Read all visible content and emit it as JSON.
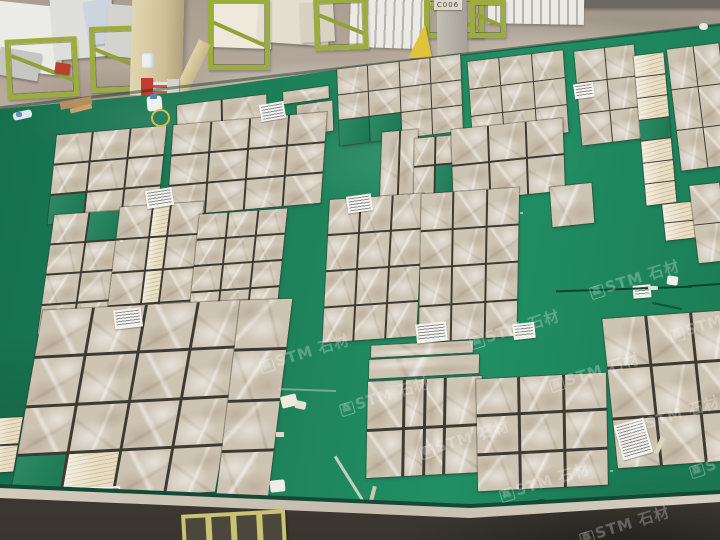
{
  "meta": {
    "description": "Photograph: dry-lay inspection area in a stone factory. Beige emperador-light marble tiles are laid out in grid patterns on a green painted floor; slabs and green racks line the warehouse wall at the top; small white specification cards (text illegible) sit beside tile groups.",
    "scene_type": "photograph"
  },
  "sign": {
    "text": "C006"
  },
  "watermark": {
    "text": "STM 石材",
    "logo_text": "鑫",
    "color": "#ffffff",
    "opacity": 0.27,
    "instances": [
      {
        "x": 258,
        "y": 342
      },
      {
        "x": 338,
        "y": 385
      },
      {
        "x": 418,
        "y": 428
      },
      {
        "x": 498,
        "y": 471
      },
      {
        "x": 578,
        "y": 514
      },
      {
        "x": 468,
        "y": 318
      },
      {
        "x": 548,
        "y": 361
      },
      {
        "x": 628,
        "y": 404
      },
      {
        "x": 688,
        "y": 447
      },
      {
        "x": 588,
        "y": 268
      },
      {
        "x": 668,
        "y": 311
      }
    ]
  },
  "palette": {
    "floor_green": "#1d8158",
    "grout_dark": "#3d3a31",
    "marble_base": "#cec4b4",
    "travertine_strip": "#e8dec5",
    "concrete_top": "#b2a79a",
    "rack_green": "#9dac3e",
    "stand_yellow": "#e0c33c",
    "curb_light": "#cdc5b6",
    "concrete_dark": "#46423b"
  },
  "tile_groups": [
    {
      "x": 177,
      "y": 100,
      "w": 90,
      "h": 40,
      "cols": 2,
      "rows": 1,
      "rot": -7,
      "skew": -6,
      "gap": 2
    },
    {
      "x": 283,
      "y": 89,
      "w": 46,
      "h": 12,
      "cols": 1,
      "rows": 1,
      "rot": -8,
      "skew": -6,
      "gap": 1
    },
    {
      "x": 297,
      "y": 103,
      "w": 36,
      "h": 30,
      "cols": 1,
      "rows": 1,
      "rot": -8,
      "skew": -6,
      "gap": 1
    },
    {
      "x": 338,
      "y": 62,
      "w": 124,
      "h": 76,
      "cols": 4,
      "rows": 3,
      "rot": -7,
      "skew": -5,
      "gap": 1,
      "holes": [
        8,
        9
      ]
    },
    {
      "x": 470,
      "y": 56,
      "w": 96,
      "h": 82,
      "cols": 3,
      "rows": 3,
      "rot": -7,
      "skew": -3,
      "gap": 1
    },
    {
      "x": 578,
      "y": 48,
      "w": 60,
      "h": 94,
      "cols": 2,
      "rows": 3,
      "rot": -7,
      "skew": -2,
      "gap": 1
    },
    {
      "x": 640,
      "y": 54,
      "w": 30,
      "h": 150,
      "cols": 1,
      "rows": 7,
      "rot": -7,
      "skew": -2,
      "gap": 1,
      "allStrip": true,
      "holes": [
        3
      ]
    },
    {
      "x": 674,
      "y": 46,
      "w": 52,
      "h": 122,
      "cols": 2,
      "rows": 3,
      "rot": -7,
      "skew": 0,
      "gap": 1
    },
    {
      "x": 664,
      "y": 203,
      "w": 32,
      "h": 36,
      "cols": 1,
      "rows": 2,
      "rot": -6,
      "skew": 0,
      "gap": 1,
      "allStrip": true
    },
    {
      "x": 694,
      "y": 184,
      "w": 30,
      "h": 78,
      "cols": 1,
      "rows": 2,
      "rot": -6,
      "skew": 1,
      "gap": 1
    },
    {
      "x": 52,
      "y": 131,
      "w": 110,
      "h": 88,
      "cols": 3,
      "rows": 3,
      "rot": -5,
      "skew": -11,
      "gap": 2,
      "holes": [
        6
      ]
    },
    {
      "x": 170,
      "y": 119,
      "w": 154,
      "h": 90,
      "cols": 4,
      "rows": 3,
      "rot": -5,
      "skew": -9,
      "gap": 2
    },
    {
      "x": 46,
      "y": 212,
      "w": 106,
      "h": 118,
      "cols": 3,
      "rows": 4,
      "rot": -4,
      "skew": -12,
      "gap": 2,
      "holes": [
        1
      ]
    },
    {
      "x": 112,
      "y": 205,
      "w": 84,
      "h": 130,
      "cols": 3,
      "rows": 4,
      "rot": -4,
      "skew": -11,
      "gap": 2,
      "colTemplate": "1.1fr .55fr 1.1fr",
      "strips": [
        1,
        4,
        7
      ]
    },
    {
      "x": 194,
      "y": 212,
      "w": 88,
      "h": 102,
      "cols": 3,
      "rows": 4,
      "rot": -4,
      "skew": -10,
      "gap": 2
    },
    {
      "x": 381,
      "y": 131,
      "w": 36,
      "h": 64,
      "cols": 2,
      "rows": 1,
      "rot": -5,
      "skew": -7,
      "gap": 2
    },
    {
      "x": 414,
      "y": 137,
      "w": 42,
      "h": 56,
      "cols": 2,
      "rows": 2,
      "rot": -5,
      "skew": -6,
      "gap": 2,
      "holes": [
        3
      ]
    },
    {
      "x": 452,
      "y": 124,
      "w": 112,
      "h": 72,
      "cols": 3,
      "rows": 2,
      "rot": -6,
      "skew": -4,
      "gap": 2
    },
    {
      "x": 326,
      "y": 197,
      "w": 94,
      "h": 142,
      "cols": 3,
      "rows": 4,
      "rot": -4,
      "skew": -7,
      "gap": 2
    },
    {
      "x": 420,
      "y": 191,
      "w": 98,
      "h": 148,
      "cols": 3,
      "rows": 4,
      "rot": -4,
      "skew": -5,
      "gap": 2
    },
    {
      "x": 551,
      "y": 185,
      "w": 42,
      "h": 40,
      "cols": 1,
      "rows": 1,
      "rot": -6,
      "skew": -2,
      "gap": 2
    },
    {
      "x": 26,
      "y": 306,
      "w": 206,
      "h": 190,
      "cols": 4,
      "rows": 4,
      "rot": -3,
      "skew": -13,
      "gap": 3,
      "holes": [
        12
      ],
      "strips": [
        13
      ]
    },
    {
      "x": 228,
      "y": 300,
      "w": 52,
      "h": 200,
      "cols": 1,
      "rows": 4,
      "rot": -2,
      "skew": -9,
      "gap": 3
    },
    {
      "x": 371,
      "y": 343,
      "w": 102,
      "h": 12,
      "cols": 1,
      "rows": 1,
      "rot": -3,
      "skew": -4,
      "gap": 2
    },
    {
      "x": 369,
      "y": 357,
      "w": 110,
      "h": 19,
      "cols": 1,
      "rows": 1,
      "rot": -3,
      "skew": -4,
      "gap": 2
    },
    {
      "x": 367,
      "y": 379,
      "w": 114,
      "h": 96,
      "cols": 4,
      "rows": 2,
      "rot": -3,
      "skew": -4,
      "gap": 3,
      "colTemplate": "1fr .52fr .52fr 1fr"
    },
    {
      "x": 477,
      "y": 376,
      "w": 130,
      "h": 112,
      "cols": 3,
      "rows": 3,
      "rot": -3,
      "skew": -2,
      "gap": 3
    },
    {
      "x": 610,
      "y": 314,
      "w": 132,
      "h": 150,
      "cols": 3,
      "rows": 3,
      "rot": -4,
      "skew": 2,
      "gap": 3
    },
    {
      "x": -8,
      "y": 418,
      "w": 26,
      "h": 54,
      "cols": 1,
      "rows": 2,
      "rot": -3,
      "skew": -13,
      "gap": 2,
      "allStrip": true
    }
  ],
  "labels": [
    {
      "x": 260,
      "y": 103,
      "w": 21,
      "h": 13,
      "rot": -10
    },
    {
      "x": 574,
      "y": 83,
      "w": 16,
      "h": 11,
      "rot": -8
    },
    {
      "x": 146,
      "y": 189,
      "w": 23,
      "h": 14,
      "rot": -9
    },
    {
      "x": 347,
      "y": 195,
      "w": 21,
      "h": 13,
      "rot": -8
    },
    {
      "x": 114,
      "y": 309,
      "w": 24,
      "h": 15,
      "rot": -7
    },
    {
      "x": 416,
      "y": 323,
      "w": 27,
      "h": 15,
      "rot": -6
    },
    {
      "x": 513,
      "y": 323,
      "w": 18,
      "h": 12,
      "rot": -6
    },
    {
      "x": 633,
      "y": 285,
      "w": 14,
      "h": 9,
      "rot": -5
    },
    {
      "x": 618,
      "y": 421,
      "w": 27,
      "h": 32,
      "rot": -16
    },
    {
      "x": 77,
      "y": 487,
      "w": 40,
      "h": 24,
      "rot": -3
    }
  ],
  "debris": [
    {
      "name": "white-jug",
      "x": 147,
      "y": 96,
      "w": 15,
      "h": 15,
      "bg": "#eef1f2",
      "radius": "3px",
      "rot": -5
    },
    {
      "name": "jug-cap",
      "x": 150,
      "y": 94,
      "w": 7,
      "h": 5,
      "bg": "#5a82b8",
      "radius": "1px"
    },
    {
      "name": "wire-coil",
      "x": 151,
      "y": 109,
      "w": 15,
      "h": 14,
      "border": "2px solid #d4bd55",
      "radius": "50%"
    },
    {
      "name": "wood-plank",
      "x": 60,
      "y": 99,
      "w": 32,
      "h": 8,
      "bg": "#b78c5e",
      "rot": -10
    },
    {
      "name": "wood-plank",
      "x": 70,
      "y": 106,
      "w": 22,
      "h": 5,
      "bg": "#caa06c",
      "rot": -14
    },
    {
      "name": "plastic-bottle",
      "x": 13,
      "y": 111,
      "w": 19,
      "h": 8,
      "bg": "#e3e8ec",
      "radius": "3px",
      "rot": -12
    },
    {
      "name": "bottle-cap",
      "x": 16,
      "y": 112,
      "w": 6,
      "h": 5,
      "bg": "#6b8fc0",
      "radius": "2px"
    },
    {
      "name": "foam-piece",
      "x": 281,
      "y": 395,
      "w": 16,
      "h": 12,
      "bg": "#efeade",
      "radius": "2px",
      "rot": -14
    },
    {
      "name": "foam-piece",
      "x": 295,
      "y": 401,
      "w": 11,
      "h": 8,
      "bg": "#e6e0d4",
      "radius": "2px",
      "rot": 12
    },
    {
      "name": "foam-piece",
      "x": 276,
      "y": 432,
      "w": 8,
      "h": 5,
      "bg": "#ddd8cb"
    },
    {
      "name": "foam-box",
      "x": 270,
      "y": 480,
      "w": 15,
      "h": 12,
      "bg": "#f2ede4",
      "radius": "2px",
      "rot": -6
    },
    {
      "name": "foam-piece",
      "x": 667,
      "y": 276,
      "w": 11,
      "h": 9,
      "bg": "#eef0ea",
      "radius": "2px",
      "rot": 8
    },
    {
      "name": "white-object",
      "x": 699,
      "y": 23,
      "w": 9,
      "h": 7,
      "bg": "#e9e9e5",
      "radius": "50%"
    },
    {
      "name": "stone-stick",
      "x": 657,
      "y": 437,
      "w": 5,
      "h": 17,
      "bg": "#ddd5c0",
      "radius": "1px",
      "rot": 24
    },
    {
      "name": "stone-stick",
      "x": 371,
      "y": 486,
      "w": 4,
      "h": 15,
      "bg": "#cfc7b4",
      "rot": 14
    },
    {
      "name": "metal-clamp",
      "x": 532,
      "y": 499,
      "w": 22,
      "h": 27,
      "bg": "#3b372e",
      "radius": "30% 50% 20% 40%",
      "rot": -12
    },
    {
      "name": "metal-clamp",
      "x": 564,
      "y": 501,
      "w": 19,
      "h": 27,
      "bg": "#464238",
      "radius": "40% 30% 40% 20%",
      "rot": 10
    },
    {
      "name": "floor-crack",
      "x": 556,
      "y": 288,
      "w": 136,
      "h": 2,
      "bg": "#0d4430",
      "rot": -2
    },
    {
      "name": "floor-crack",
      "x": 688,
      "y": 284,
      "w": 34,
      "h": 2,
      "bg": "#0d4430",
      "rot": -4
    },
    {
      "name": "crack-filler",
      "x": 648,
      "y": 286,
      "w": 10,
      "h": 4,
      "bg": "#dfe4da",
      "radius": "2px"
    },
    {
      "name": "floor-scratch",
      "x": 349,
      "y": 452,
      "w": 3,
      "h": 58,
      "bg": "rgba(225,220,205,.85)",
      "rot": -32
    },
    {
      "name": "floor-scratch",
      "x": 278,
      "y": 389,
      "w": 58,
      "h": 2,
      "bg": "rgba(210,205,190,.5)",
      "rot": 2
    },
    {
      "name": "hook-mark",
      "x": 652,
      "y": 305,
      "w": 30,
      "h": 2,
      "bg": "#14523a",
      "rot": 12
    },
    {
      "name": "paint-fleck",
      "x": 120,
      "y": 240,
      "w": 3,
      "h": 2,
      "bg": "rgba(235,235,225,.6)"
    },
    {
      "name": "paint-fleck",
      "x": 520,
      "y": 212,
      "w": 3,
      "h": 2,
      "bg": "rgba(235,235,225,.6)"
    },
    {
      "name": "paint-fleck",
      "x": 200,
      "y": 430,
      "w": 4,
      "h": 2,
      "bg": "rgba(235,235,225,.5)"
    },
    {
      "name": "paint-fleck",
      "x": 610,
      "y": 470,
      "w": 3,
      "h": 2,
      "bg": "rgba(235,235,225,.5)"
    }
  ],
  "warehouse": {
    "slabs": [
      {
        "x": -8,
        "y": 4,
        "w": 72,
        "h": 68,
        "rot": 6,
        "bg": "#ebebe8"
      },
      {
        "x": 52,
        "y": -4,
        "w": 62,
        "h": 62,
        "rot": -5,
        "bg": "#dfdfdb"
      },
      {
        "x": 86,
        "y": 0,
        "w": 28,
        "h": 44,
        "rot": -9,
        "bg": "#ccd5dd"
      },
      {
        "x": 106,
        "y": 6,
        "w": 54,
        "h": 52,
        "rot": 5,
        "bg": "#d3d3cf"
      },
      {
        "x": -2,
        "y": 50,
        "w": 42,
        "h": 28,
        "rot": 10,
        "bg": "#c6c7c3"
      },
      {
        "x": 210,
        "y": -6,
        "w": 62,
        "h": 54,
        "rot": 2,
        "bg": "#efe9dc"
      },
      {
        "x": 258,
        "y": -4,
        "w": 72,
        "h": 48,
        "rot": 4,
        "bg": "#e4decf"
      },
      {
        "x": 300,
        "y": 2,
        "w": 34,
        "h": 40,
        "rot": -3,
        "bg": "#d8d2c2"
      },
      {
        "x": 580,
        "y": -2,
        "w": 146,
        "h": 10,
        "rot": 0,
        "bg": "#6e6862"
      }
    ],
    "stacks": [
      {
        "x": 350,
        "y": -2,
        "w": 80,
        "h": 50,
        "rot": 2
      },
      {
        "x": 488,
        "y": -2,
        "w": 96,
        "h": 26,
        "rot": 1
      }
    ],
    "frames": [
      {
        "x": 6,
        "y": 38,
        "w": 62,
        "h": 50,
        "rot": -3
      },
      {
        "x": 90,
        "y": 26,
        "w": 48,
        "h": 56,
        "rot": -2
      },
      {
        "x": 208,
        "y": -2,
        "w": 52,
        "h": 62,
        "rot": 0
      },
      {
        "x": 314,
        "y": -2,
        "w": 44,
        "h": 42,
        "rot": -2
      },
      {
        "x": 424,
        "y": -4,
        "w": 50,
        "h": 32,
        "rot": 0
      },
      {
        "x": 470,
        "y": 0,
        "w": 26,
        "h": 28,
        "rot": 0
      }
    ],
    "props": [
      {
        "type": "column",
        "x": 131,
        "y": -4,
        "w": 52,
        "h": 100,
        "rot": 1.5
      },
      {
        "type": "plank",
        "x": 180,
        "y": 38,
        "w": 13,
        "h": 84,
        "rot": 26
      },
      {
        "type": "pillar",
        "x": 437,
        "y": -2,
        "w": 30,
        "h": 60,
        "rot": -1
      },
      {
        "type": "stand",
        "x": 408,
        "y": 24
      },
      {
        "type": "bucket",
        "x": 142,
        "y": 53,
        "w": 13,
        "h": 15
      },
      {
        "type": "box",
        "x": 55,
        "y": 63,
        "w": 15,
        "h": 11,
        "rot": 8,
        "bg": "#b8402f"
      },
      {
        "type": "box",
        "x": 141,
        "y": 78,
        "w": 12,
        "h": 18,
        "bg": "#c23b2e"
      },
      {
        "type": "box",
        "x": 153,
        "y": 82,
        "w": 14,
        "h": 15,
        "bg": "repeating-linear-gradient(0deg,#e8e3da 0 3px,#c75b4a 3px 6px)"
      },
      {
        "type": "box",
        "x": 167,
        "y": 79,
        "w": 12,
        "h": 17,
        "bg": "#d8d3ca"
      }
    ]
  }
}
